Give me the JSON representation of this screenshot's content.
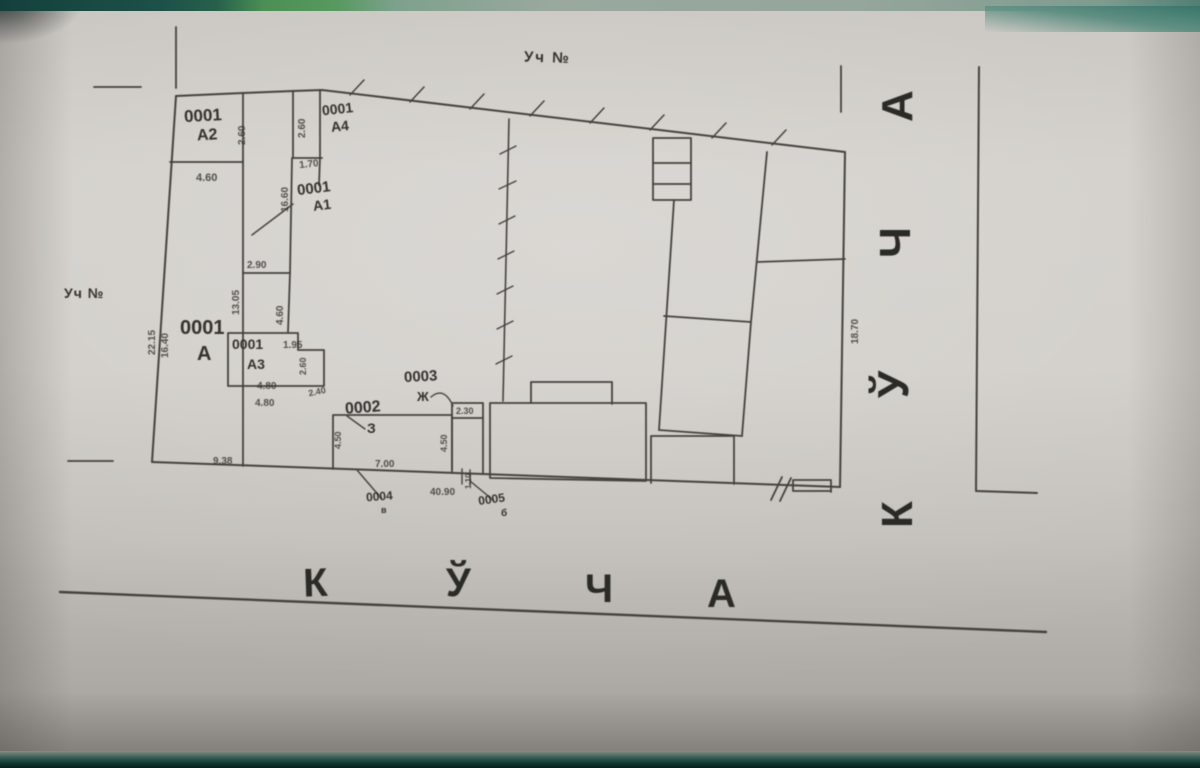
{
  "document_kind": "scanned land plot plan",
  "palette": {
    "paper": "#d0cdc8",
    "paper_edge": "#a29e9a",
    "ink": "#45423d",
    "text_ink": "#35322e",
    "photo_strip_teal": "#1c5048",
    "photo_strip_green": "#57995f",
    "photo_strip_bottom": "#123831"
  },
  "annotations": {
    "uch_top": "Уч №",
    "uch_left": "Уч №"
  },
  "street": {
    "bottom_letters": [
      "К",
      "Ў",
      "Ч",
      "А"
    ],
    "right_letters": [
      "К",
      "Ў",
      "Ч",
      "А"
    ]
  },
  "parcels": {
    "a2_code": "0001",
    "a2_lit": "А2",
    "a4_code": "0001",
    "a4_lit": "А4",
    "a1_code": "0001",
    "a1_lit": "А1",
    "a_code": "0001",
    "a_lit": "А",
    "a3_code": "0001",
    "a3_lit": "А3",
    "b2_code": "0002",
    "b2_lit": "З",
    "b3_code": "0003",
    "b3_lit": "Ж",
    "b4_code": "0004",
    "b4_lit": "в",
    "b5_code": "0005",
    "b5_lit": "б"
  },
  "dims": {
    "a2_height": "2.60",
    "a2_width": "4.60",
    "a4_height": "2.60",
    "a4_width": "1.70",
    "a1_height": "16.60",
    "corridor_width": "2.90",
    "corridor_height": "13.05",
    "mid_height": "4.60",
    "left_len_outer": "22.15",
    "left_len_inner": "16.40",
    "a3_notch": "1.95",
    "a3_side": "2.60",
    "a3_width_top": "4.80",
    "a3_step": "2.40",
    "a3_width": "4.80",
    "yard_width": "9.38",
    "b2_height": "4.50",
    "b2_width": "7.00",
    "b3_height": "4.50",
    "b3_width": "2.30",
    "frontage": "40.90",
    "gate_width": "1.10",
    "right_len": "18.70"
  }
}
